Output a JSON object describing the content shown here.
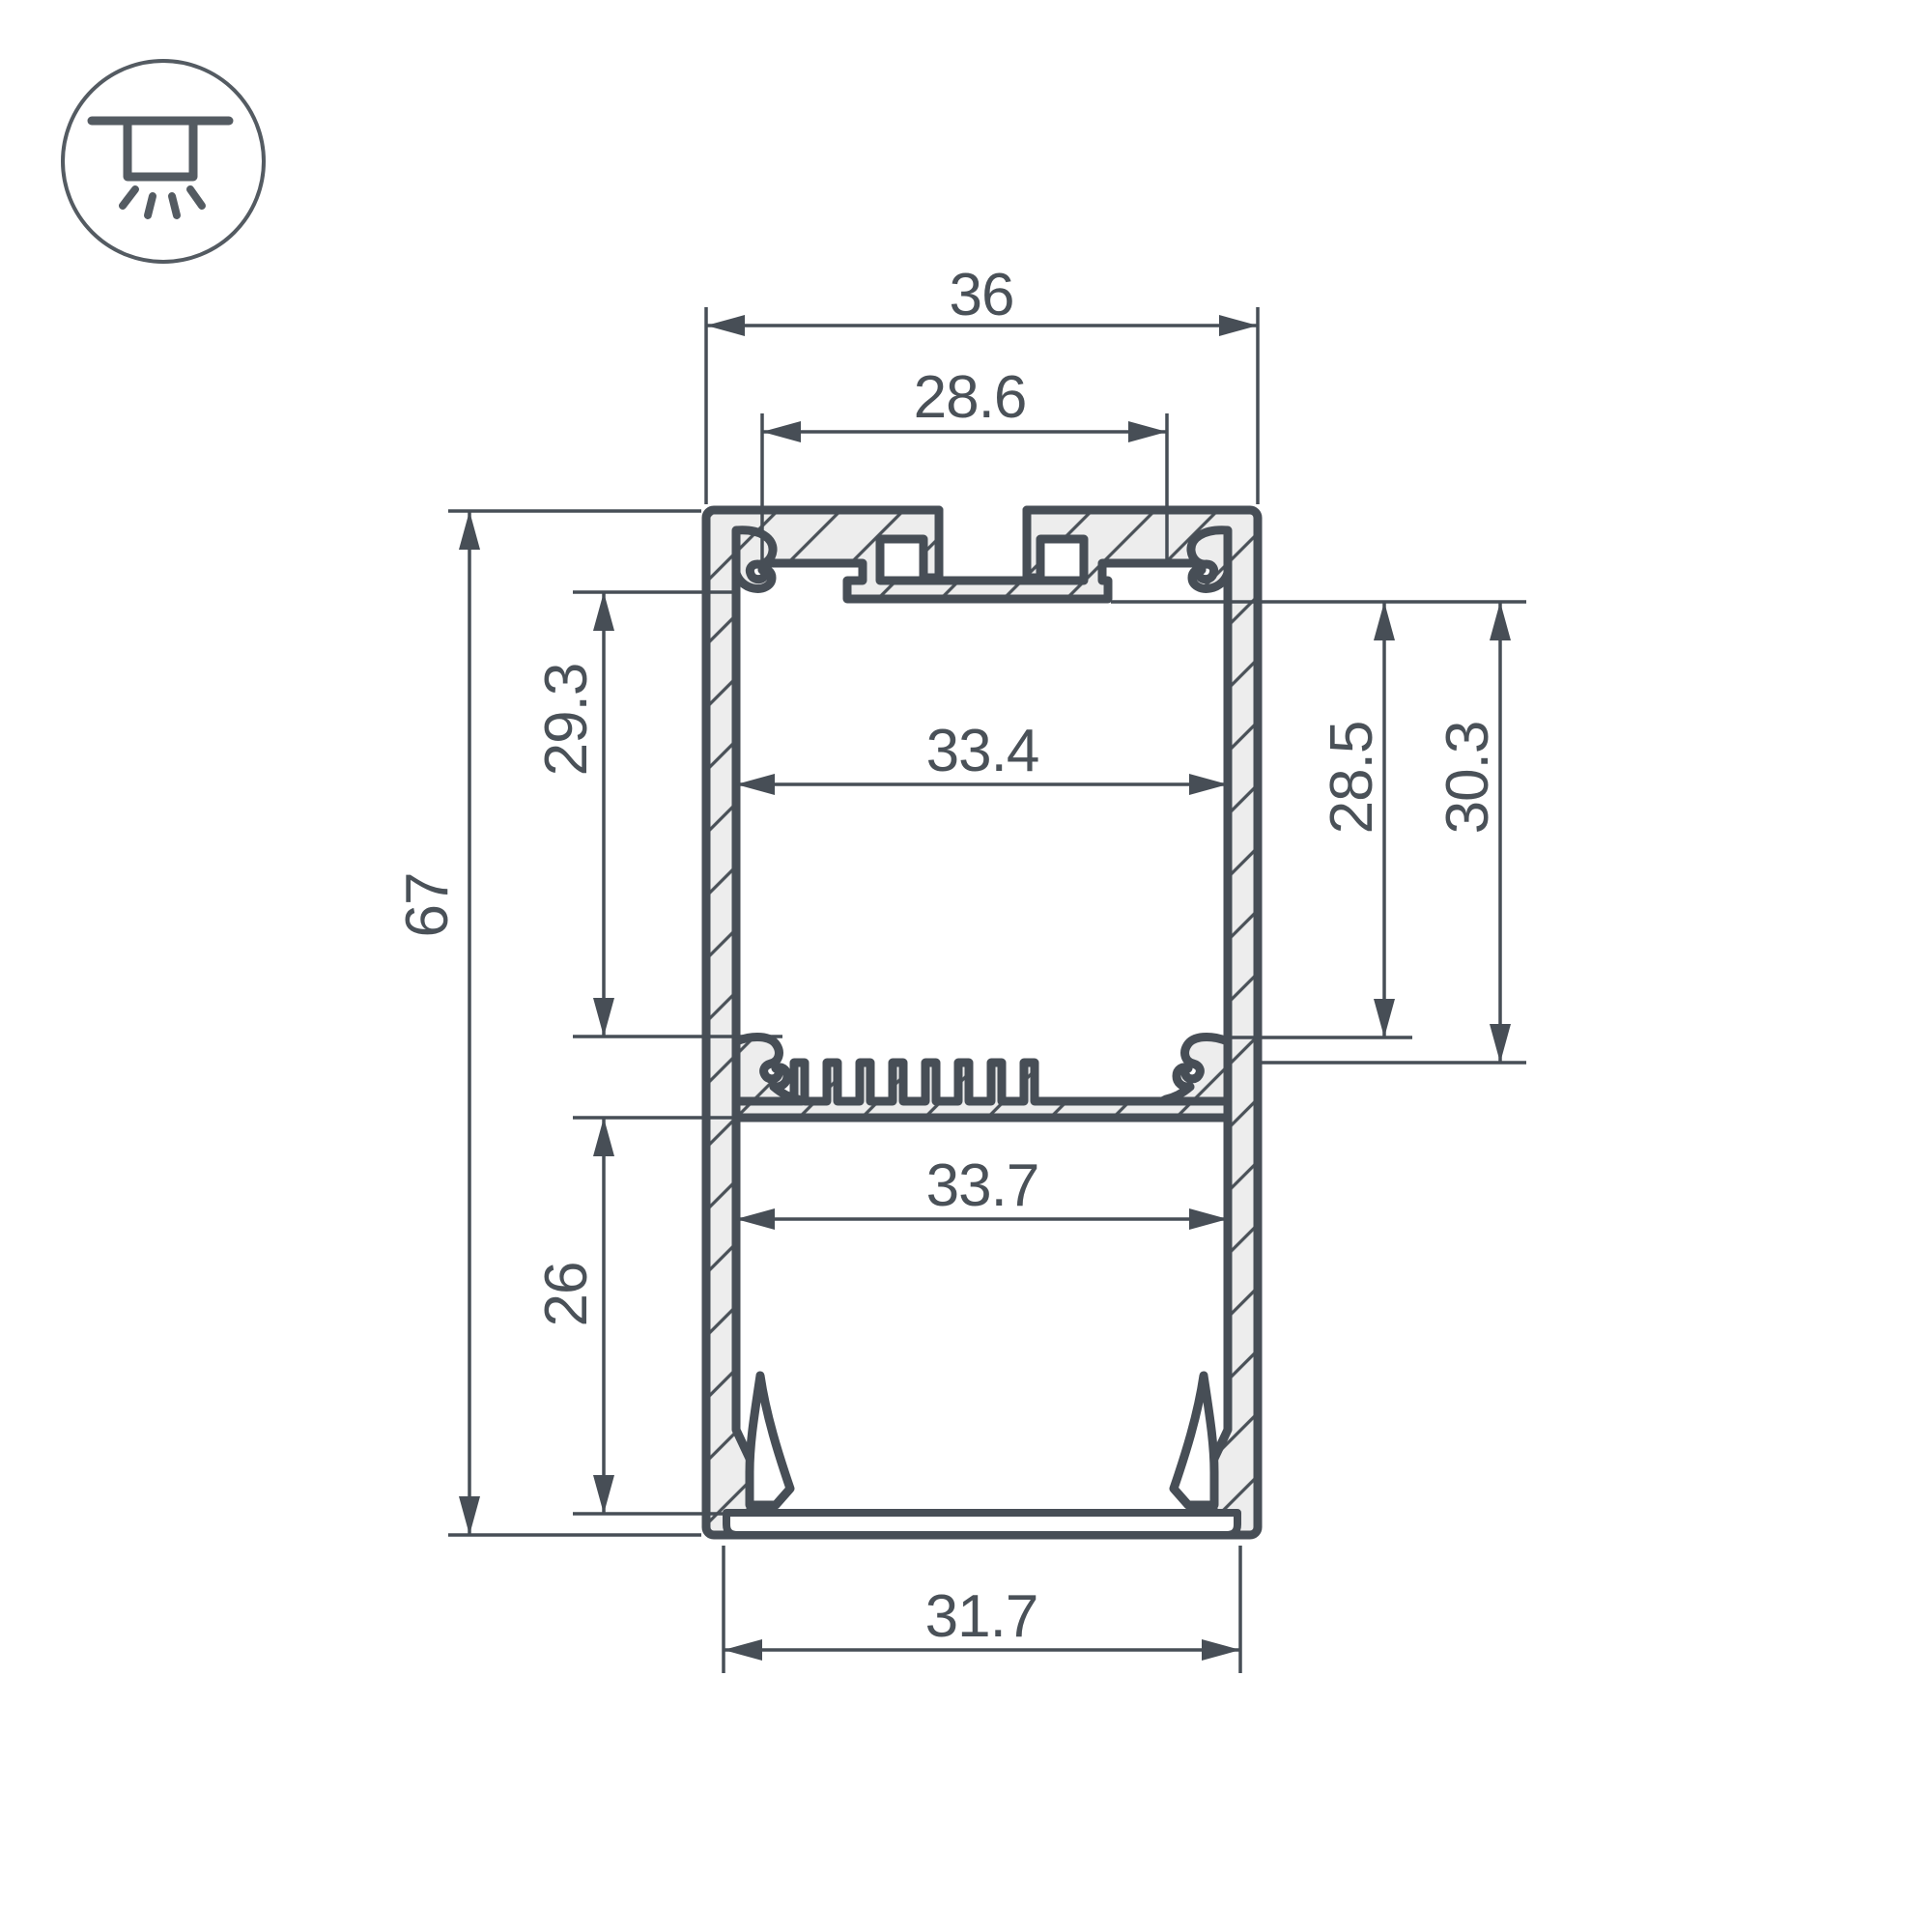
{
  "drawing": {
    "title": "LED profile cross-section drawing",
    "units": "mm"
  },
  "colors": {
    "line": "#474e56",
    "text": "#4a5158",
    "hatch_fill": "#ededed",
    "background": "#ffffff"
  },
  "icon": {
    "name": "ceiling-mounted-luminaire-icon"
  },
  "dimensions": {
    "top_width": {
      "label": "36"
    },
    "mount_slot_width": {
      "label": "28.6"
    },
    "upper_inner_width": {
      "label": "33.4"
    },
    "upper_chamber_height": {
      "label": "29.3"
    },
    "total_height": {
      "label": "67"
    },
    "lower_chamber_height": {
      "label": "26"
    },
    "height_to_ledge": {
      "label": "28.5"
    },
    "height_to_fins": {
      "label": "30.3"
    },
    "lower_inner_width": {
      "label": "33.7"
    },
    "bottom_width": {
      "label": "31.7"
    }
  }
}
